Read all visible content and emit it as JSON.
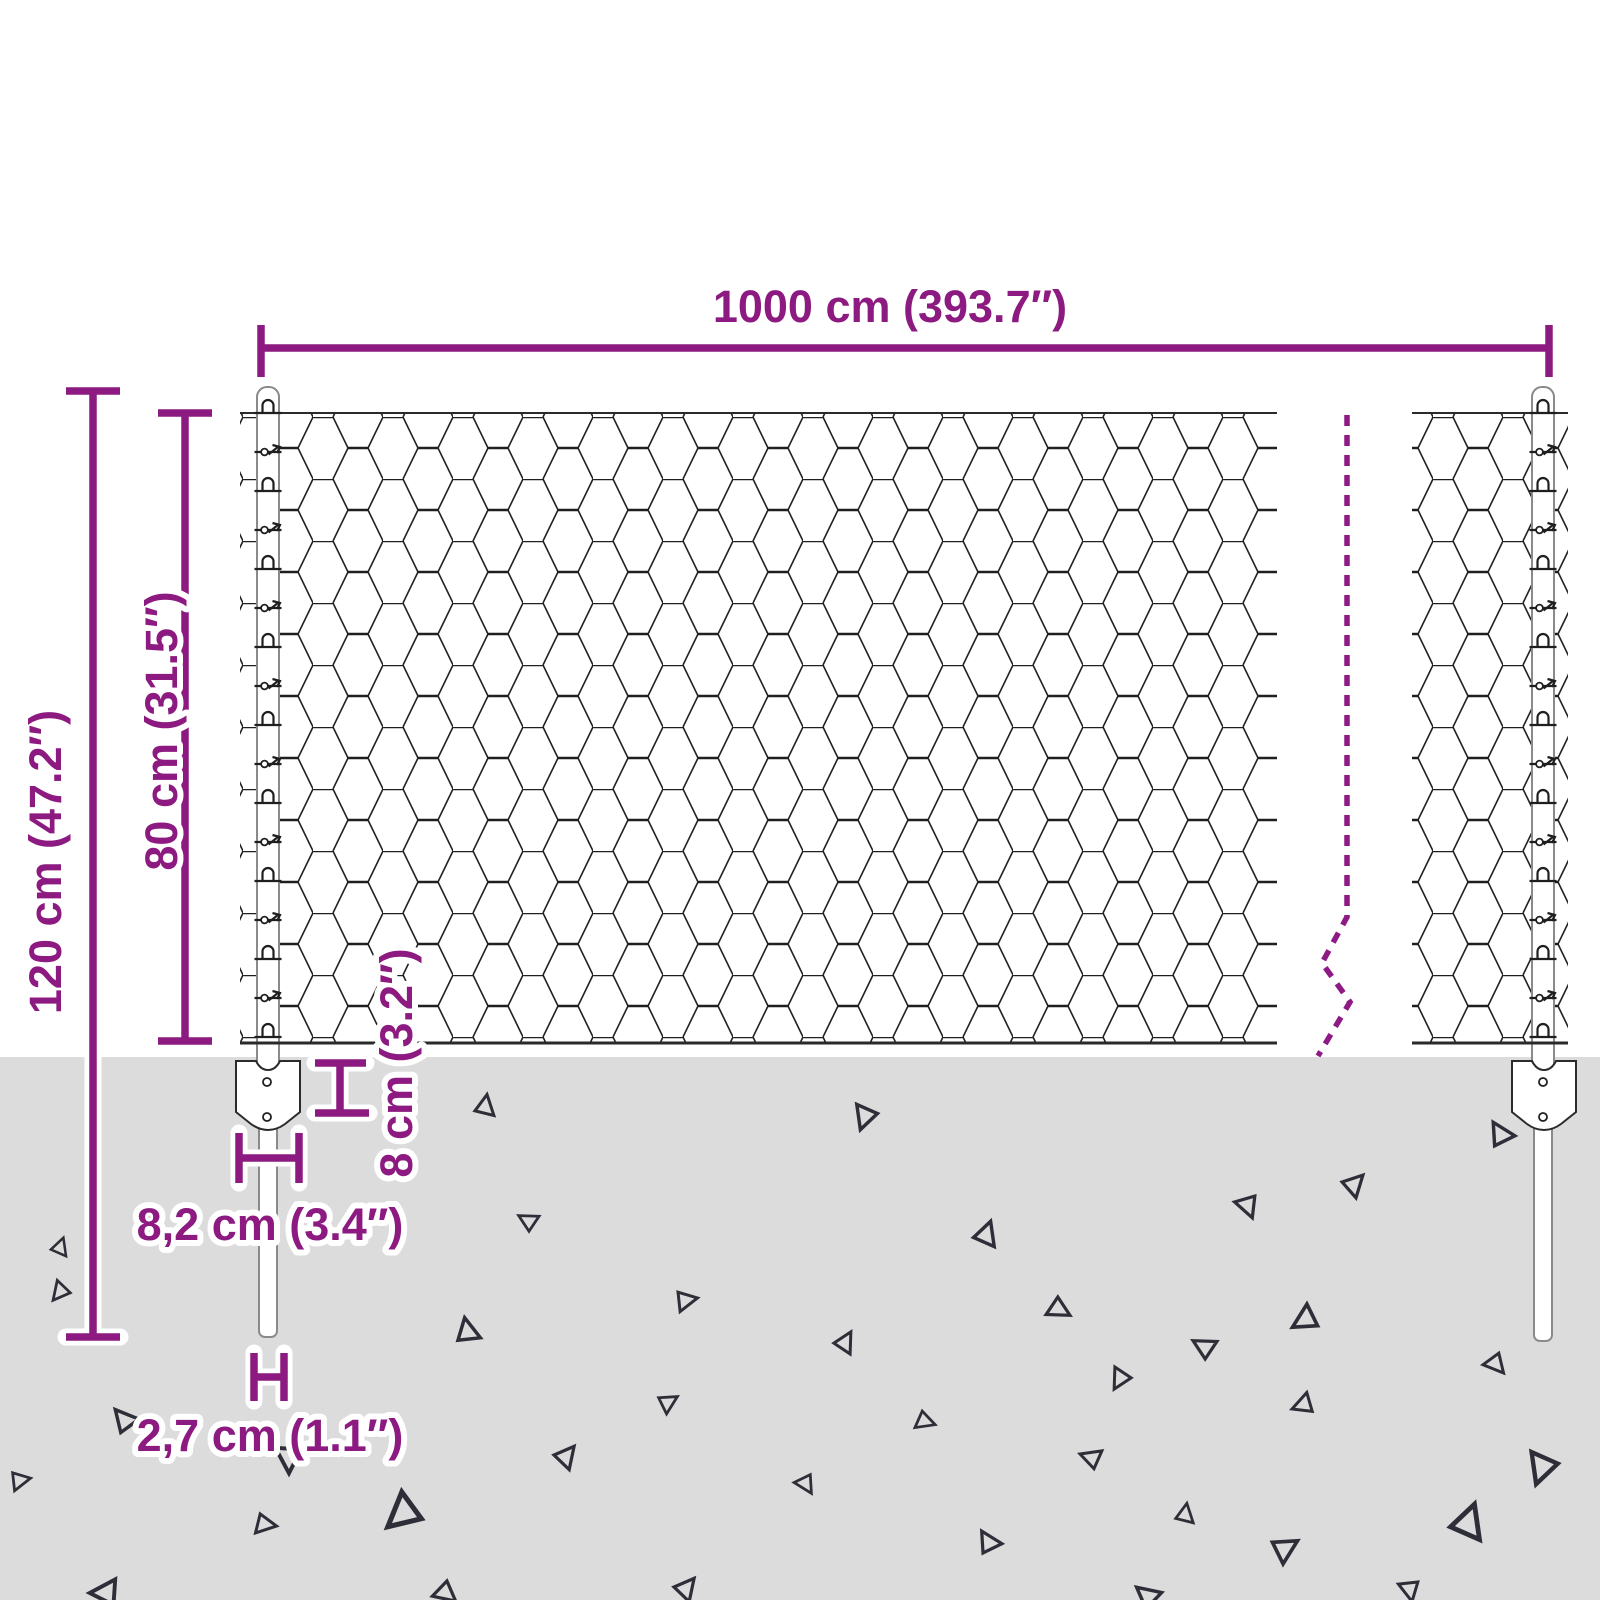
{
  "diagram": {
    "type": "wire-mesh-fence-dimension-diagram",
    "labels": {
      "total_width": "1000 cm (393.7″)",
      "post_height": "120 cm (47.2″)",
      "fence_height": "80 cm (31.5″)",
      "anchor_depth": "8 cm (3.2″)",
      "anchor_width": "8,2 cm (3.4″)",
      "post_width": "2,7 cm (1.1″)"
    },
    "colors": {
      "accent": "#8C1A80",
      "break_line": "#8E1A85",
      "ground": "#DCDCDC",
      "mesh_line": "#1F1F1F",
      "post_outline": "#8A8A8A",
      "speck": "#2E2E38",
      "background": "#FFFFFF"
    }
  }
}
